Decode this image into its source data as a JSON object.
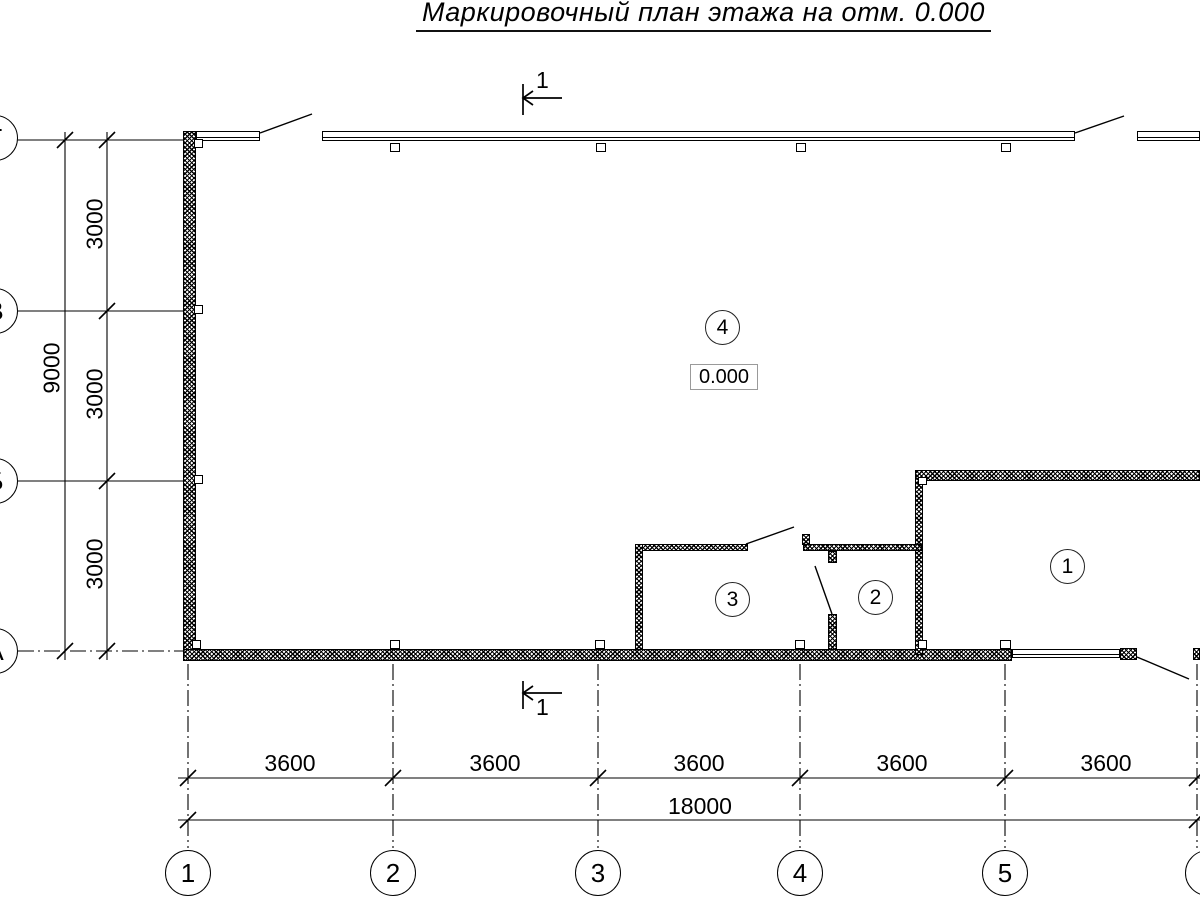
{
  "title": "Маркировочный план этажа на отм. 0.000",
  "section_marks": {
    "top": "1",
    "bottom": "1"
  },
  "elevation": "0.000",
  "rooms": {
    "r1": "1",
    "r2": "2",
    "r3": "3",
    "r4": "4"
  },
  "axes": {
    "bottom": [
      "1",
      "2",
      "3",
      "4",
      "5",
      "6"
    ],
    "left": [
      "Г",
      "В",
      "Б",
      "А"
    ]
  },
  "dimensions": {
    "bottom_spans": [
      "3600",
      "3600",
      "3600",
      "3600",
      "3600"
    ],
    "bottom_total": "18000",
    "left_spans": [
      "3000",
      "3000",
      "3000"
    ],
    "left_total": "9000"
  },
  "colors": {
    "line": "#000000",
    "background": "#ffffff"
  }
}
